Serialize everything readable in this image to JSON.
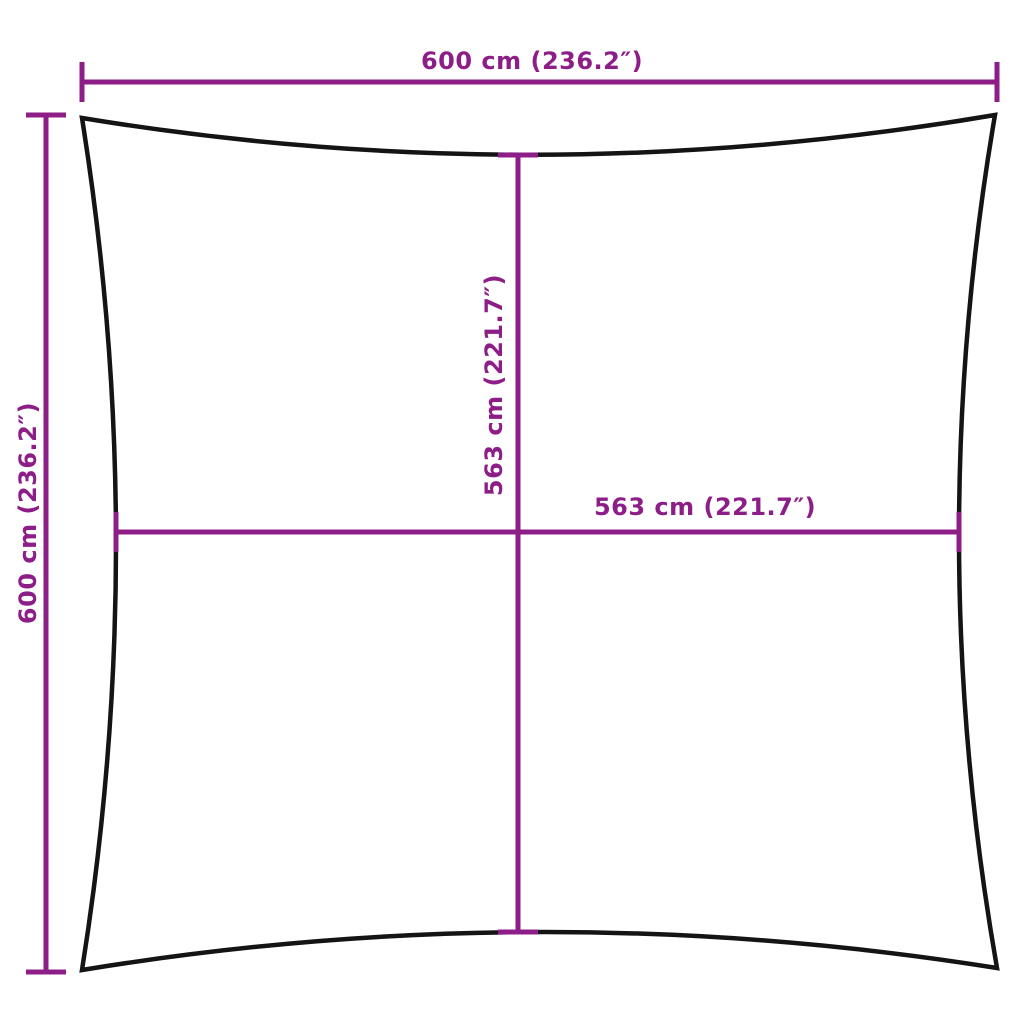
{
  "diagram": {
    "colors": {
      "dimension_lines": "#8E1E87",
      "outline": "#141414",
      "background": "#FFFFFF"
    },
    "labels": {
      "top_width": "600 cm (236.2″)",
      "left_height": "600 cm (236.2″)",
      "center_height": "563 cm (221.7″)",
      "center_width": "563 cm (221.7″)"
    }
  }
}
